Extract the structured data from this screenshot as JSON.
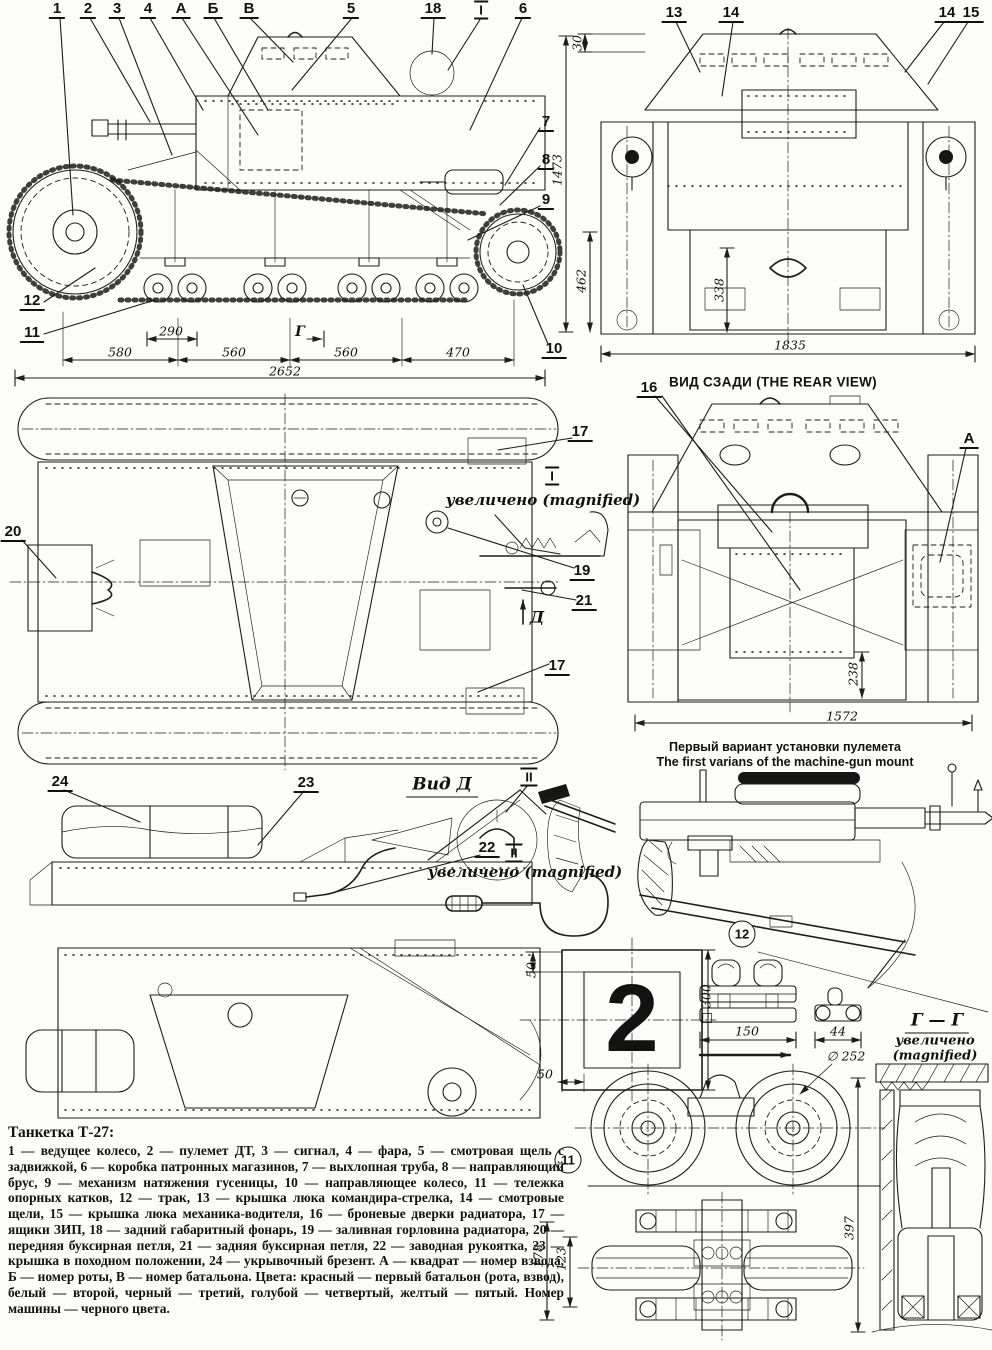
{
  "captions": {
    "rear_view_title": "ВИД СЗАДИ (THE REAR VIEW)",
    "mg_mount_ru": "Первый вариант установки пулемета",
    "mg_mount_en": "The first varians of the machine-gun mount",
    "view_d": "Вид Д",
    "magnified_top": "увеличено (magnified)",
    "magnified_crank": "увеличено (magnified)",
    "section_gg": "Г — Г",
    "section_gg_magnified_1": "увеличено",
    "section_gg_magnified_2": "(magnified)",
    "plate_number": "2"
  },
  "legend": {
    "title": "Танкетка Т-27:",
    "body": "1 — ведущее колесо, 2 — пулемет ДТ, 3 — сигнал, 4 — фара, 5 — смотровая щель с задвижкой, 6 — коробка патронных магазинов, 7 — выхлопная труба, 8 — направляющий брус, 9 — механизм натяжения гусеницы, 10 — направляющее колесо, 11 — тележка опорных катков, 12 — трак, 13 — крышка люка командира-стрелка, 14 — смотровые щели, 15 — крышка люка механика-водителя, 16 — броневые дверки радиатора, 17 — ящики ЗИП, 18 — задний габаритный фонарь, 19 — заливная горловина радиатора, 20 — передняя буксирная петля, 21 — задняя буксирная петля, 22 — заводная рукоятка, 23 — крышка в походном положении, 24 — укрывочный брезент. А — квадрат — номер взвода, Б — номер роты, В — номер батальона. Цвета: красный — первый батальон (рота, взвод), белый — второй, черный — третий, голубой — четвертый, желтый — пятый. Номер машины — черного цвета."
  },
  "labels": [
    {
      "name": "callout-1",
      "text": "1",
      "x": 57,
      "y": 10,
      "cls": "callout"
    },
    {
      "name": "callout-2",
      "text": "2",
      "x": 88,
      "y": 10,
      "cls": "callout"
    },
    {
      "name": "callout-3",
      "text": "3",
      "x": 117,
      "y": 10,
      "cls": "callout"
    },
    {
      "name": "callout-4",
      "text": "4",
      "x": 148,
      "y": 10,
      "cls": "callout"
    },
    {
      "name": "callout-a",
      "text": "А",
      "x": 181,
      "y": 10,
      "cls": "callout"
    },
    {
      "name": "callout-b",
      "text": "Б",
      "x": 213,
      "y": 10,
      "cls": "callout"
    },
    {
      "name": "callout-v",
      "text": "В",
      "x": 249,
      "y": 10,
      "cls": "callout"
    },
    {
      "name": "callout-5",
      "text": "5",
      "x": 351,
      "y": 10,
      "cls": "callout"
    },
    {
      "name": "callout-18",
      "text": "18",
      "x": 433,
      "y": 10,
      "cls": "callout"
    },
    {
      "name": "section-mark-1",
      "text": "I",
      "x": 481,
      "y": 10,
      "cls": "roman"
    },
    {
      "name": "callout-6",
      "text": "6",
      "x": 523,
      "y": 10,
      "cls": "callout"
    },
    {
      "name": "callout-7",
      "text": "7",
      "x": 546,
      "y": 123,
      "cls": "callout"
    },
    {
      "name": "callout-8",
      "text": "8",
      "x": 546,
      "y": 161,
      "cls": "callout"
    },
    {
      "name": "callout-9",
      "text": "9",
      "x": 546,
      "y": 201,
      "cls": "callout"
    },
    {
      "name": "callout-10",
      "text": "10",
      "x": 554,
      "y": 350,
      "cls": "callout"
    },
    {
      "name": "callout-12",
      "text": "12",
      "x": 32,
      "y": 302,
      "cls": "callout"
    },
    {
      "name": "callout-11",
      "text": "11",
      "x": 32,
      "y": 334,
      "cls": "callout"
    },
    {
      "name": "dim-290",
      "text": "290",
      "x": 171,
      "y": 331,
      "cls": "dim"
    },
    {
      "name": "section-letter-g",
      "text": "Г",
      "x": 300,
      "y": 332,
      "cls": "dimb"
    },
    {
      "name": "dim-580",
      "text": "580",
      "x": 120,
      "y": 352,
      "cls": "dim"
    },
    {
      "name": "dim-560a",
      "text": "560",
      "x": 234,
      "y": 352,
      "cls": "dim"
    },
    {
      "name": "dim-560b",
      "text": "560",
      "x": 346,
      "y": 352,
      "cls": "dim"
    },
    {
      "name": "dim-470",
      "text": "470",
      "x": 458,
      "y": 352,
      "cls": "dim"
    },
    {
      "name": "dim-2652",
      "text": "2652",
      "x": 285,
      "y": 371,
      "cls": "dim"
    },
    {
      "name": "callout-13",
      "text": "13",
      "x": 674,
      "y": 14,
      "cls": "callout"
    },
    {
      "name": "callout-14a",
      "text": "14",
      "x": 731,
      "y": 14,
      "cls": "callout"
    },
    {
      "name": "callout-14b",
      "text": "14",
      "x": 947,
      "y": 14,
      "cls": "callout"
    },
    {
      "name": "callout-15",
      "text": "15",
      "x": 971,
      "y": 14,
      "cls": "callout"
    },
    {
      "name": "dim-30",
      "text": "30",
      "x": 577,
      "y": 43,
      "cls": "dimv"
    },
    {
      "name": "dim-1473",
      "text": "1473",
      "x": 557,
      "y": 170,
      "cls": "dimv"
    },
    {
      "name": "dim-462",
      "text": "462",
      "x": 581,
      "y": 281,
      "cls": "dimv"
    },
    {
      "name": "dim-338",
      "text": "338",
      "x": 719,
      "y": 290,
      "cls": "dimv"
    },
    {
      "name": "dim-1835",
      "text": "1835",
      "x": 790,
      "y": 345,
      "cls": "dim"
    },
    {
      "name": "callout-16",
      "text": "16",
      "x": 649,
      "y": 389,
      "cls": "callout"
    },
    {
      "name": "callout-a2",
      "text": "А",
      "x": 969,
      "y": 440,
      "cls": "callout"
    },
    {
      "name": "dim-238",
      "text": "238",
      "x": 853,
      "y": 674,
      "cls": "dimv"
    },
    {
      "name": "dim-1572",
      "text": "1572",
      "x": 842,
      "y": 716,
      "cls": "dim"
    },
    {
      "name": "callout-17a",
      "text": "17",
      "x": 580,
      "y": 433,
      "cls": "callout"
    },
    {
      "name": "section-mark-2",
      "text": "I",
      "x": 552,
      "y": 476,
      "cls": "roman"
    },
    {
      "name": "callout-19",
      "text": "19",
      "x": 582,
      "y": 572,
      "cls": "callout"
    },
    {
      "name": "callout-21",
      "text": "21",
      "x": 584,
      "y": 602,
      "cls": "callout"
    },
    {
      "name": "view-arrow-letter-d",
      "text": "Д",
      "x": 537,
      "y": 617,
      "cls": "vletter"
    },
    {
      "name": "callout-20",
      "text": "20",
      "x": 13,
      "y": 533,
      "cls": "callout"
    },
    {
      "name": "callout-17b",
      "text": "17",
      "x": 557,
      "y": 667,
      "cls": "callout"
    },
    {
      "name": "callout-24",
      "text": "24",
      "x": 60,
      "y": 783,
      "cls": "callout"
    },
    {
      "name": "callout-23",
      "text": "23",
      "x": 306,
      "y": 784,
      "cls": "callout"
    },
    {
      "name": "section-mark-3",
      "text": "II",
      "x": 529,
      "y": 777,
      "cls": "roman"
    },
    {
      "name": "callout-22",
      "text": "22",
      "x": 487,
      "y": 849,
      "cls": "callout"
    },
    {
      "name": "section-mark-4",
      "text": "II",
      "x": 514,
      "y": 853,
      "cls": "roman"
    },
    {
      "name": "circled-12",
      "text": "12",
      "x": 742,
      "y": 934,
      "cls": "circled"
    },
    {
      "name": "dim-50-top",
      "text": "50",
      "x": 531,
      "y": 970,
      "cls": "dimv"
    },
    {
      "name": "dim-50-bottom",
      "text": "50",
      "x": 545,
      "y": 1074,
      "cls": "dim"
    },
    {
      "name": "dim-300",
      "text": "□ 300",
      "x": 706,
      "y": 1004,
      "cls": "dimv"
    },
    {
      "name": "dim-150",
      "text": "150",
      "x": 747,
      "y": 1031,
      "cls": "dim"
    },
    {
      "name": "dim-44",
      "text": "44",
      "x": 838,
      "y": 1031,
      "cls": "dim"
    },
    {
      "name": "dim-252",
      "text": "∅ 252",
      "x": 846,
      "y": 1056,
      "cls": "dim"
    },
    {
      "name": "circled-11",
      "text": "11",
      "x": 568,
      "y": 1160,
      "cls": "circled"
    },
    {
      "name": "dim-178",
      "text": "178",
      "x": 538,
      "y": 1256,
      "cls": "dimv"
    },
    {
      "name": "dim-123",
      "text": "123",
      "x": 561,
      "y": 1259,
      "cls": "dimv"
    },
    {
      "name": "dim-397",
      "text": "397",
      "x": 849,
      "y": 1228,
      "cls": "dimv"
    }
  ]
}
